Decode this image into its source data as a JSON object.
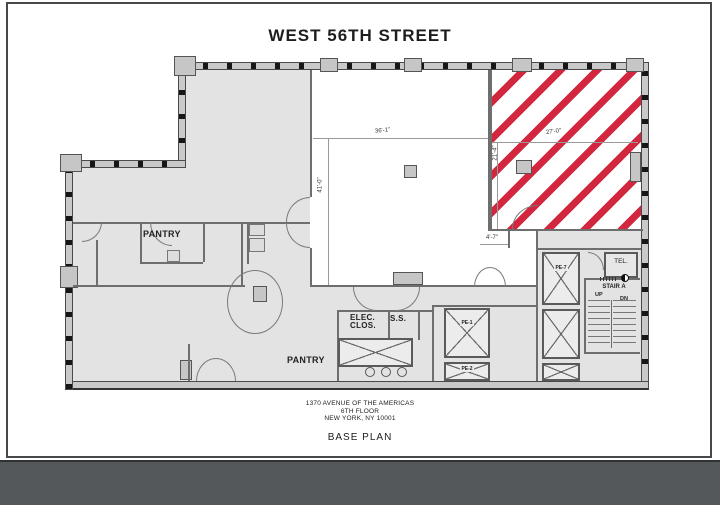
{
  "drawing": {
    "street_title": "WEST 56TH STREET",
    "labels": {
      "pantry_upper": "PANTRY",
      "pantry_lower": "PANTRY",
      "elec_line1": "ELEC.",
      "elec_line2": "CLOS.",
      "ss": "S.S.",
      "tel": "TEL.",
      "stair": "STAIR A",
      "up": "UP",
      "dn": "DN",
      "pe1": "PE-1",
      "pe2": "PE-2",
      "pe7": "PE-7"
    },
    "dimensions": {
      "open_area_width": "36'-1\"",
      "open_area_depth": "41'-0\"",
      "hatched_width": "27'-0\"",
      "hatched_depth": "21'-4\"",
      "corner_offset": "4'-7\""
    },
    "title_block": {
      "line1": "1370 AVENUE OF THE AMERICAS",
      "line2": "6TH  FLOOR",
      "line3": "NEW YORK, NY 10001",
      "drawing_name": "BASE PLAN"
    },
    "colors": {
      "hatch_red": "#d2273f",
      "floor_shade": "#e3e3e3",
      "wall_fill": "#c9c9c9",
      "viewer_band": "#55585a"
    }
  }
}
